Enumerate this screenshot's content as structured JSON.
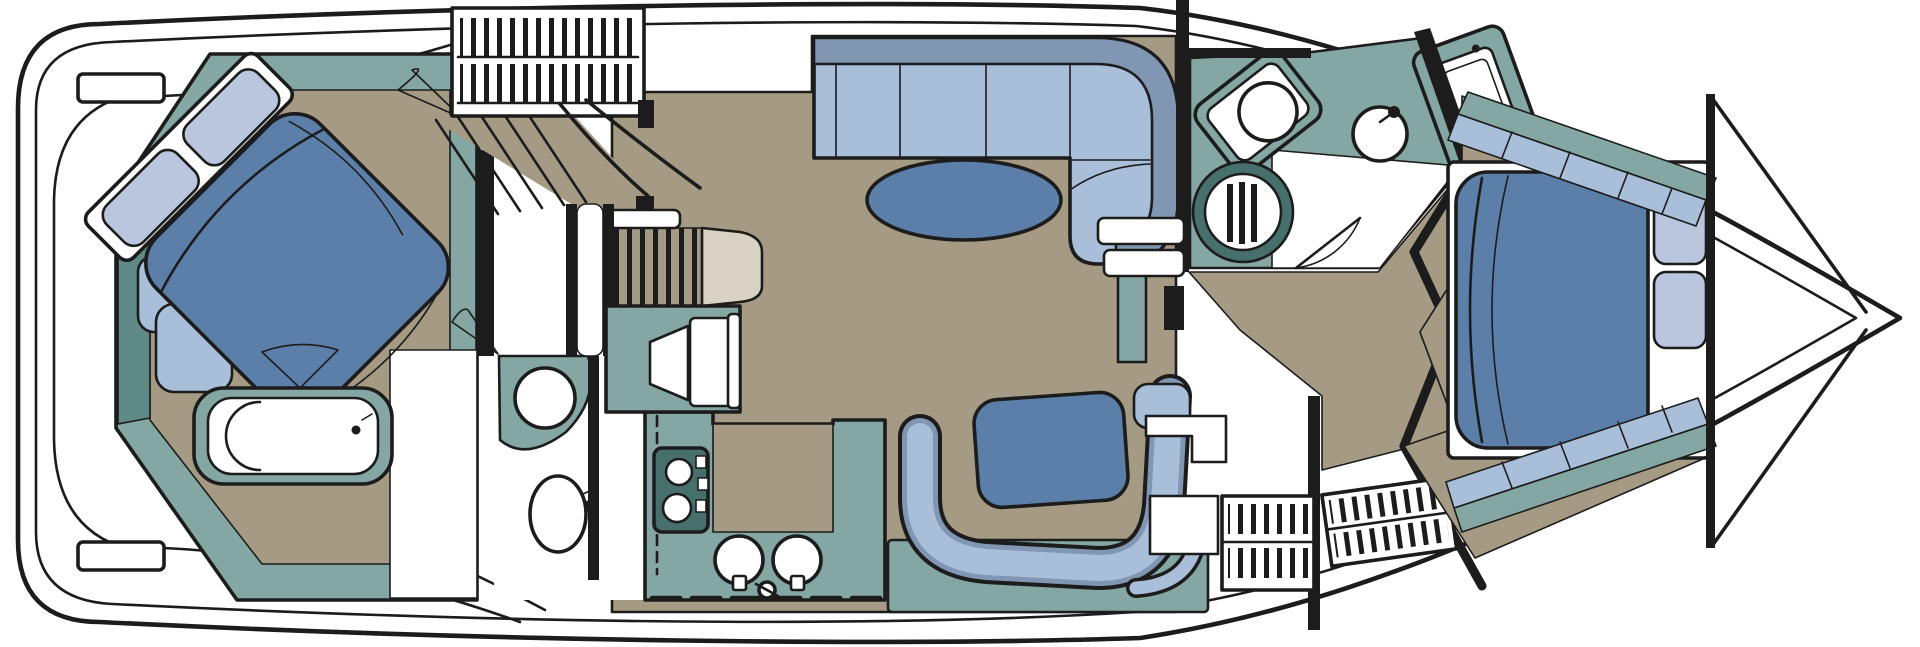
{
  "meta": {
    "label": "Motor yacht lower-deck interior floor plan, bow to the right",
    "description": "Top-down boat floor plan diagram: aft master stateroom with angled island bed and tub, companionway ladder, galley with stove and twin sinks, salon with sectional sofa and oval coffee table, dinette booth with table, forward head with vanity, toilet and shower, steps and ladders, and a forward V-berth stateroom with side shelves"
  },
  "palette": {
    "background": "#ffffff",
    "white": "#ffffff",
    "outline": "#1c1c1c",
    "teal": "#84a7a3",
    "teal_dark": "#5f8a87",
    "teal_deep": "#47706c",
    "floor": "#a59a83",
    "floor_light": "#d8d2c4",
    "blue_dark": "#5b7fa9",
    "blue_mid": "#8096b3",
    "blue_light": "#a9bed9",
    "blue_pale": "#b9c6de"
  },
  "areas": [
    {
      "id": "swim-platform",
      "fixtures": [
        "transom-steps"
      ]
    },
    {
      "id": "aft-master-stateroom",
      "fixtures": [
        "island-bed",
        "pillows",
        "bed-steps",
        "stool",
        "bathtub",
        "vanity-band"
      ]
    },
    {
      "id": "aft-head",
      "fixtures": [
        "toilet",
        "sink"
      ]
    },
    {
      "id": "companionway",
      "fixtures": [
        "ladder-hatch",
        "stairs",
        "pocket-door",
        "landing"
      ]
    },
    {
      "id": "galley",
      "fixtures": [
        "tv-cabinet",
        "stove",
        "twin-sinks",
        "island-counter",
        "faucet"
      ]
    },
    {
      "id": "salon",
      "fixtures": [
        "sectional-sofa",
        "oval-coffee-table"
      ]
    },
    {
      "id": "dinette",
      "fixtures": [
        "curved-bench",
        "table",
        "counters"
      ]
    },
    {
      "id": "forward-head",
      "fixtures": [
        "vanity-sink",
        "round-sink",
        "toilet",
        "shower-stall",
        "door"
      ]
    },
    {
      "id": "forward-corridor",
      "fixtures": [
        "steps-down",
        "ladder-hatch-port",
        "ladder-hatch-starboard"
      ]
    },
    {
      "id": "forward-stateroom",
      "fixtures": [
        "island-berth",
        "pillows",
        "side-shelves",
        "bow-bulkhead"
      ]
    }
  ]
}
